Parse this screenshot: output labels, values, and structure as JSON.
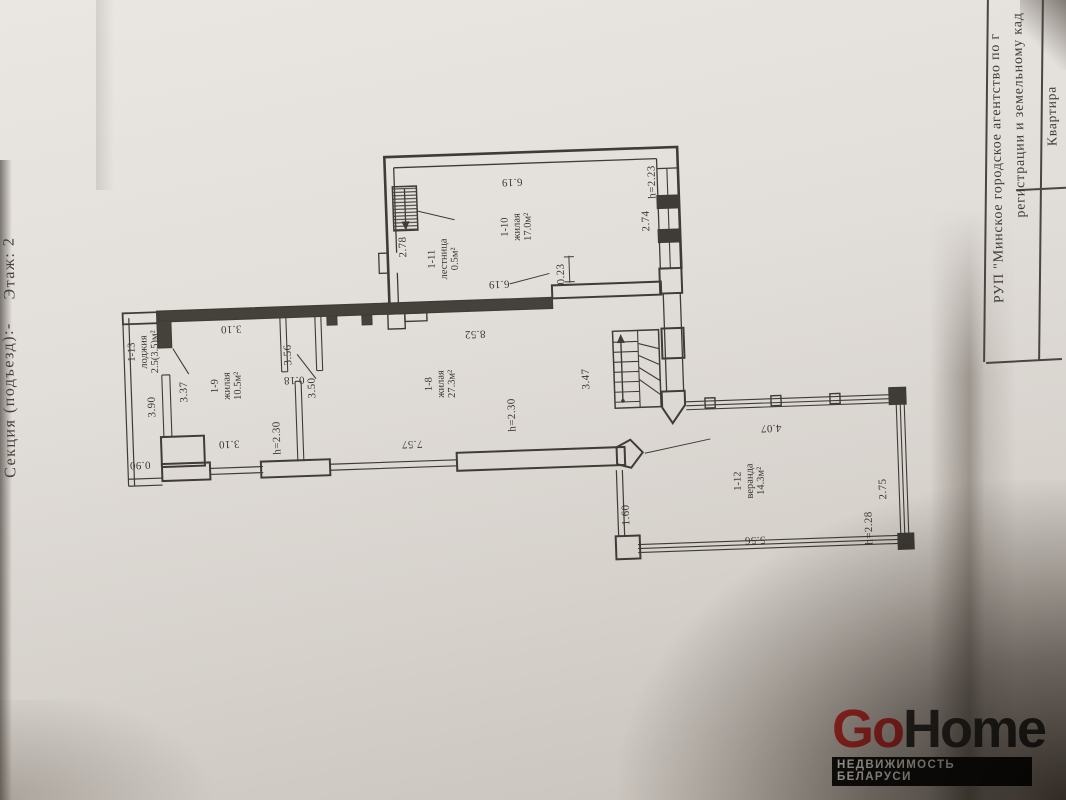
{
  "document": {
    "side_label_1": "Секция (подъезд):-",
    "side_label_2": "Этаж: 2",
    "title_block": {
      "line1": "РУП \"Минское городское агентство по г",
      "line2": "регистрации и земельному кад",
      "cell_kvartira": "Квартира"
    }
  },
  "plan": {
    "rooms": [
      {
        "id": "1-13",
        "name": "лоджия",
        "area": "2.5(3.5)м²"
      },
      {
        "id": "1-9",
        "name": "жилая",
        "area": "10.5м²"
      },
      {
        "id": "1-8",
        "name": "жилая",
        "area": "27.3м²"
      },
      {
        "id": "1-11",
        "name": "лестница",
        "area": "0.5м²"
      },
      {
        "id": "1-10",
        "name": "жилая",
        "area": "17.0м²"
      },
      {
        "id": "1-12",
        "name": "веранда",
        "area": "14.3м²"
      }
    ],
    "dims": {
      "d278": "2.78",
      "d619t": "6.19",
      "h223": "h=2.23",
      "d274": "2.74",
      "d619b": "6.19",
      "d023": "0.23",
      "d310t": "3.10",
      "d356": "3.56",
      "d018": "0.18",
      "d350": "3.50",
      "d852": "8.52",
      "d337": "3.37",
      "d390": "3.90",
      "d347": "3.47",
      "h230a": "h=2.30",
      "h230b": "h=2.30",
      "d310b": "3.10",
      "d757": "7.57",
      "d090": "0.90",
      "d160": "1.60",
      "d407": "4.07",
      "d556": "5.56",
      "h228": "h=2.28",
      "d275": "2.75"
    }
  },
  "watermark": {
    "go": "Go",
    "home": "Home",
    "tagline": "НЕДВИЖИМОСТЬ БЕЛАРУСИ"
  },
  "colors": {
    "line": "#3f3b36",
    "logo_red": "#c3302b",
    "paper": "#e2deda"
  }
}
